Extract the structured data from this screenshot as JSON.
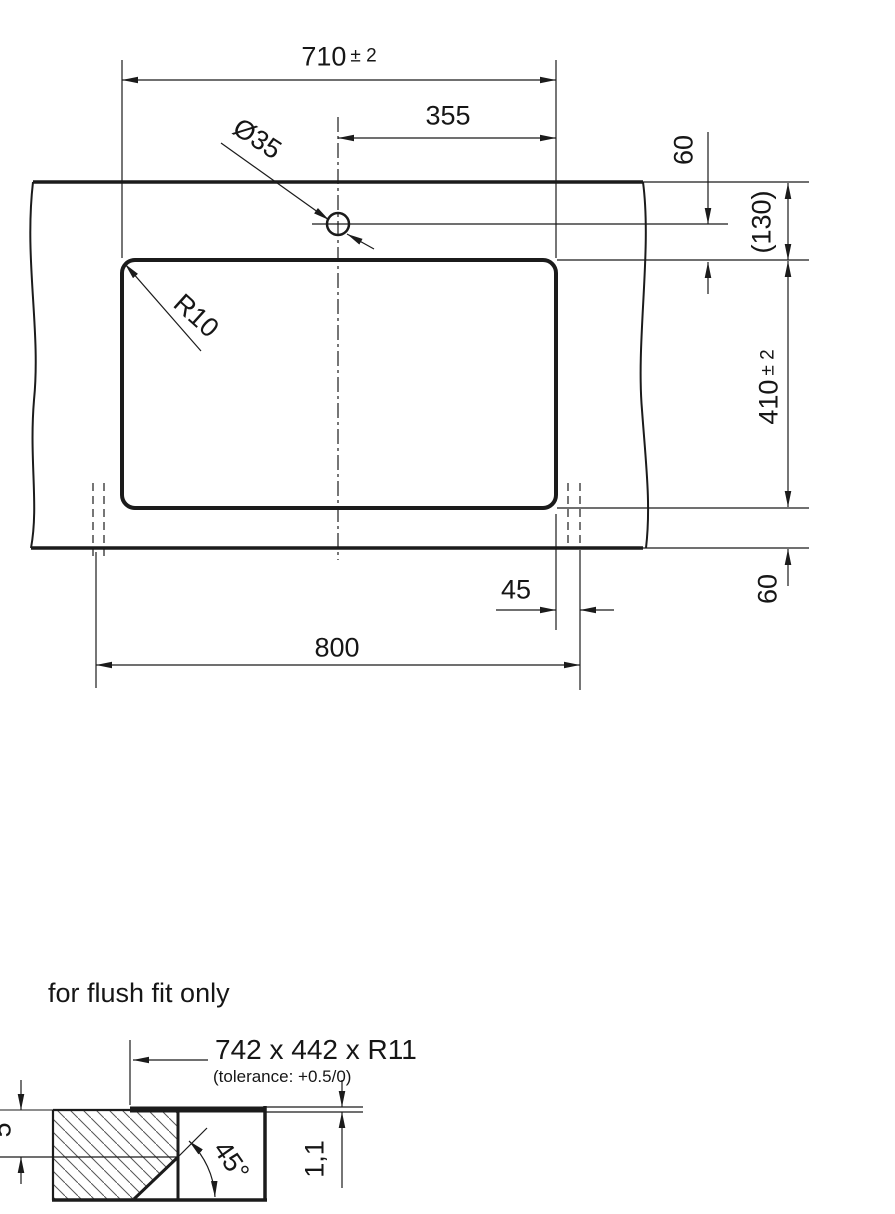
{
  "colors": {
    "background": "#ffffff",
    "ink": "#1b1b1b",
    "hatch": "#555555"
  },
  "top_view": {
    "cutout_width": {
      "value": "710",
      "tol": "± 2"
    },
    "center_offset": "355",
    "hole_diameter": "Ø35",
    "corner_radius": "R10",
    "hole_offset": "60",
    "front_overall": "(130)",
    "cutout_depth": {
      "value": "410",
      "tol": "± 2"
    },
    "rear_clearance": "60",
    "side_clearance": "45",
    "min_width": "800"
  },
  "flush_section": {
    "note": "for flush fit only",
    "recess_size": "742 x 442 x R11",
    "tolerance_note": "(tolerance: +0.5/0)",
    "chamfer_angle": "45°",
    "proud_height": "1,1",
    "recess_depth": "5"
  }
}
